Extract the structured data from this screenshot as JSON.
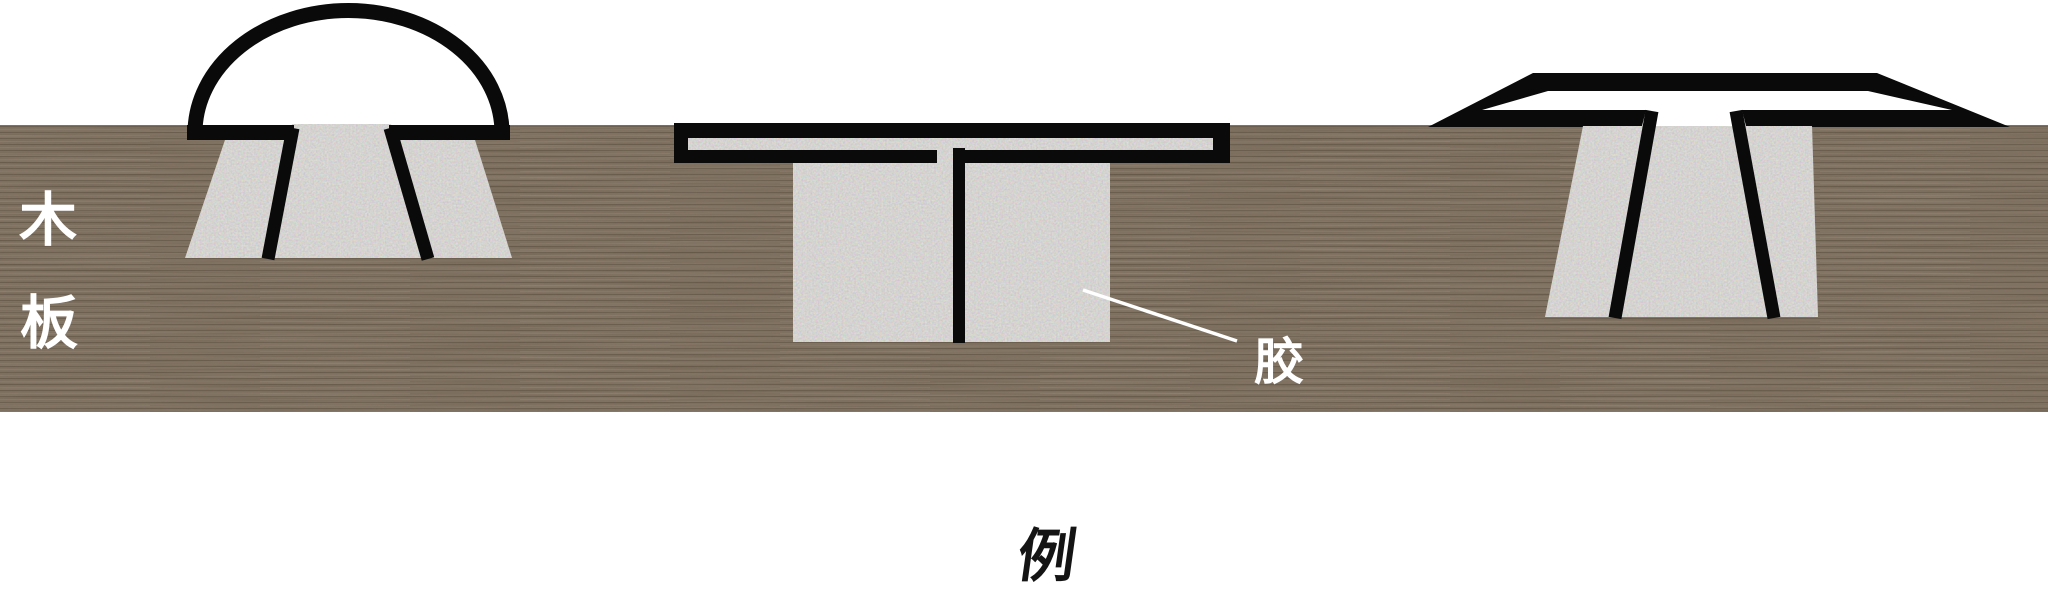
{
  "labels": {
    "board_line1": "木",
    "board_line2": "板",
    "glue": "胶",
    "caption": "例"
  },
  "colors": {
    "background": "#ffffff",
    "board_brown": "#8b7d6d",
    "board_fiber_dark": "#453a2e",
    "glue_gray": "#dbd9d6",
    "outline_black": "#0a0a0a",
    "label_white": "#ffffff",
    "caption_black": "#141414"
  },
  "joints": [
    {
      "id": "dome-cap-joint",
      "position": "left"
    },
    {
      "id": "tee-joint",
      "position": "middle"
    },
    {
      "id": "flared-tee-joint",
      "position": "right"
    }
  ]
}
